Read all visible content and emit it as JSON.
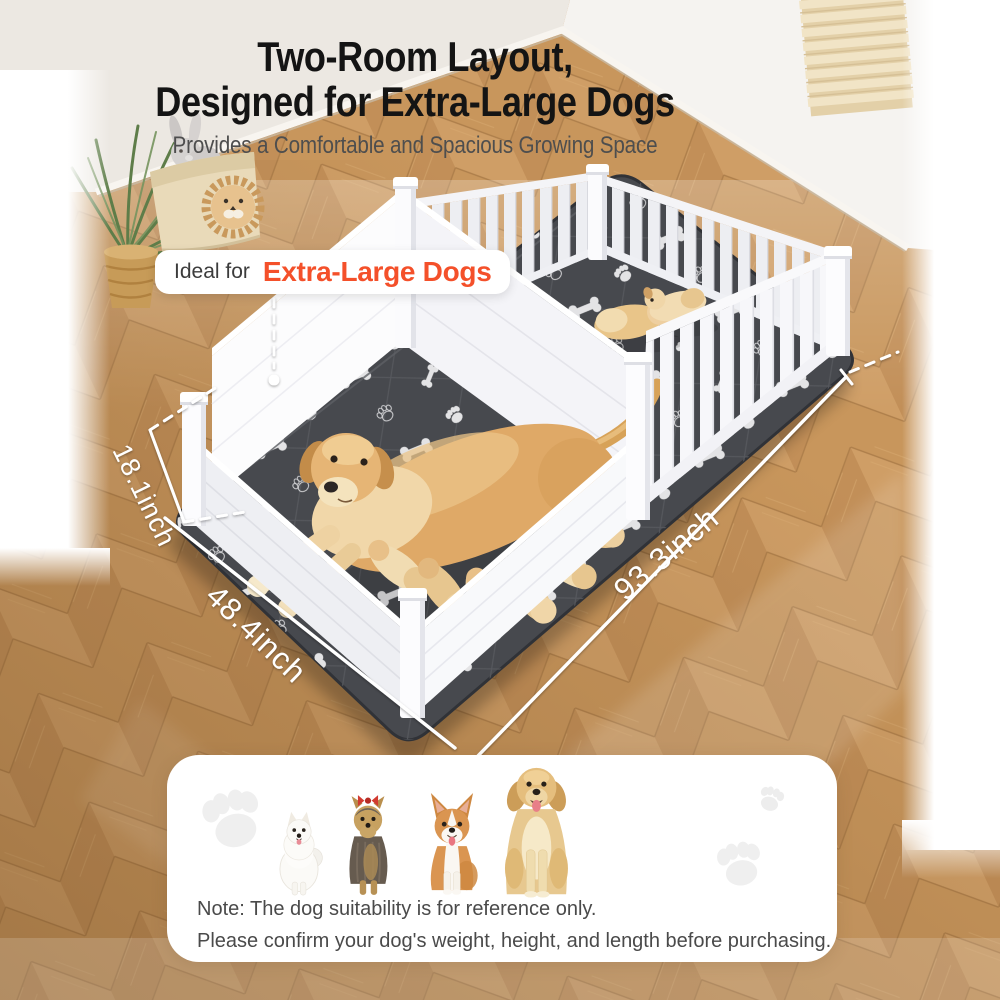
{
  "header": {
    "title_line1": "Two-Room Layout,",
    "title_line2": "Designed for Extra-Large Dogs",
    "subtitle": "Provides a Comfortable and Spacious Growing Space"
  },
  "badge": {
    "prefix": "Ideal for",
    "highlight": "Extra-Large Dogs"
  },
  "dimensions": {
    "height_label": "18.1inch",
    "width_label": "48.4inch",
    "length_label": "93.3inch"
  },
  "note": {
    "line1": "Note: The dog suitability is for reference only.",
    "line2": "Please confirm your dog's weight, height, and length before purchasing."
  },
  "colors": {
    "accent_orange": "#F4502A",
    "title_black": "#141414",
    "subtitle_gray": "#4E4E4E",
    "mat_dark_gray": "#47494E",
    "pen_white": "#F7F7FA",
    "floor_wood": "#C89555",
    "card_white": "#FFFFFF",
    "note_gray": "#4A4A4A"
  },
  "scene": {
    "decor_icons": [
      "window-blinds-icon",
      "potted-plant-icon",
      "toy-basket-icon",
      "bunny-plush-icon",
      "lion-plush-icon"
    ],
    "mat_pattern_icons": [
      "bone-icon",
      "paw-print-icon"
    ],
    "animal_photos": [
      "mother-dog-with-nursing-puppies-photo",
      "two-puppies-photo"
    ]
  },
  "size_chart": {
    "dog_icons": [
      "pomeranian-photo",
      "yorkshire-terrier-photo",
      "corgi-photo",
      "golden-retriever-photo"
    ],
    "watermark_icon": "paw-print-icon"
  }
}
